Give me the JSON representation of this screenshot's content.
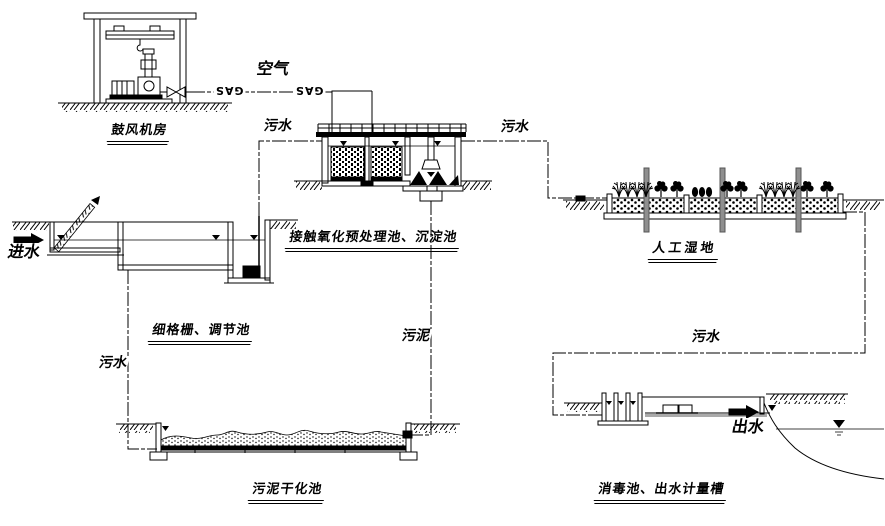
{
  "diagram": {
    "unit_titles": {
      "blower_room": "鼓风机房",
      "contact_oxidation_sedimentation": "接触氧化预处理池、沉淀池",
      "fine_screen_regulating": "细格栅、调节池",
      "constructed_wetland": "人工湿地",
      "sludge_drying_bed": "污泥干化池",
      "disinfection_metering": "消毒池、出水计量槽"
    },
    "flow_labels": {
      "air": "空气",
      "gas": "GAS",
      "sewage": "污水",
      "sludge": "污泥",
      "influent": "进水",
      "effluent": "出水"
    },
    "colors": {
      "line": "#000000",
      "background": "#ffffff"
    }
  }
}
